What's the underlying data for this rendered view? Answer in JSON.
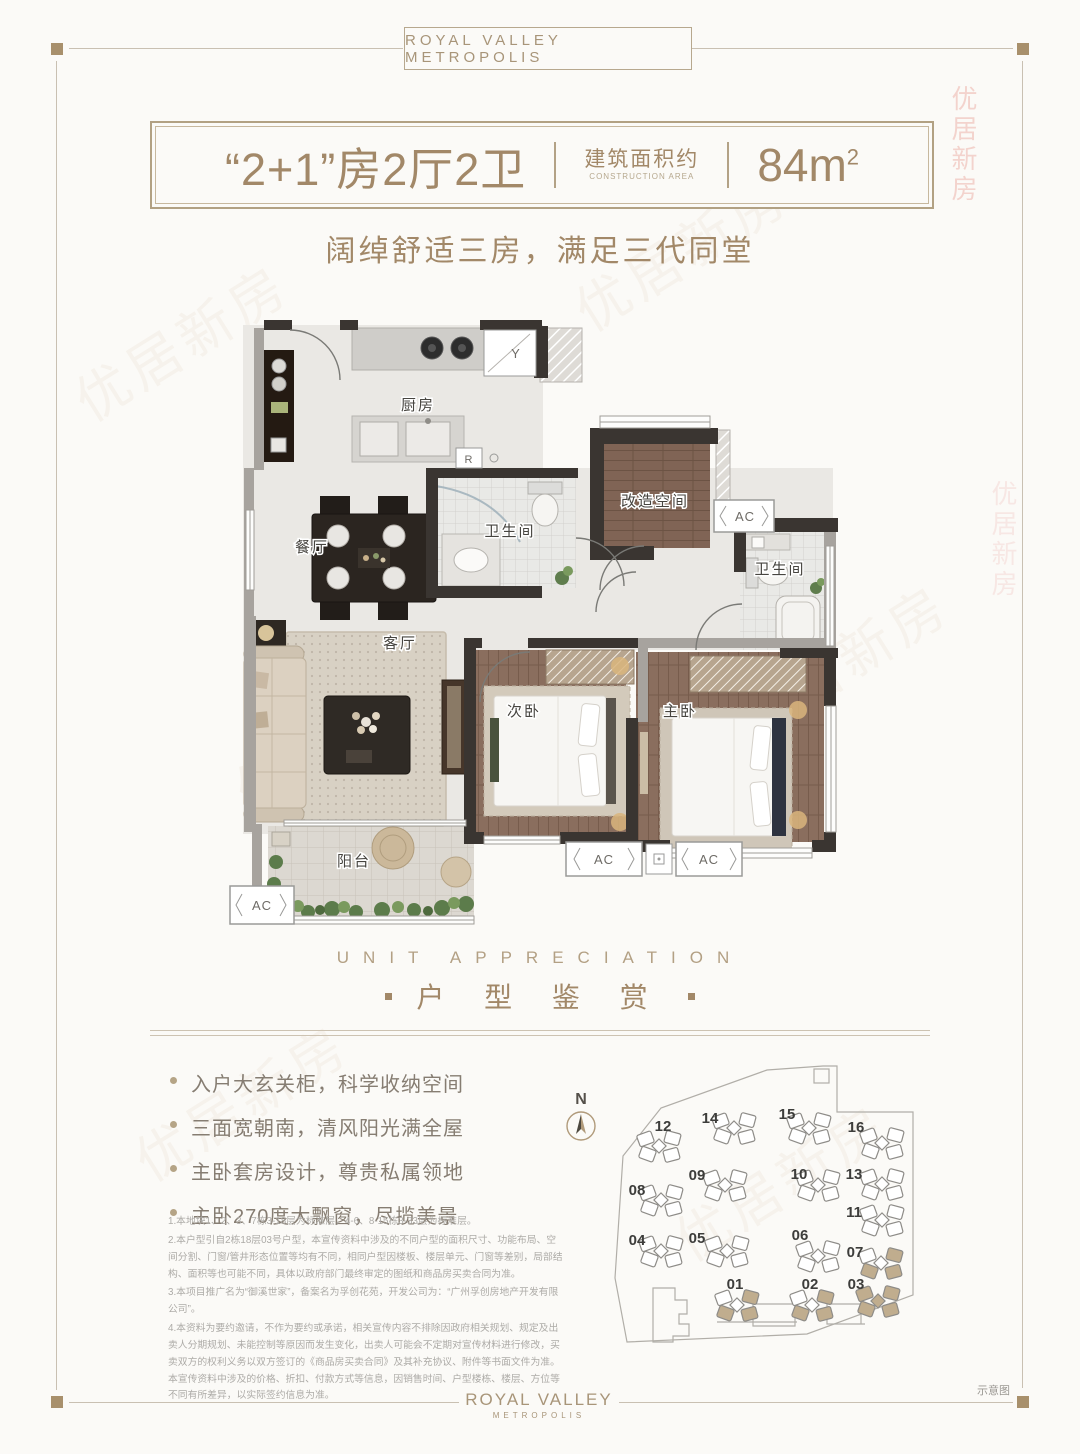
{
  "brand": {
    "header": "ROYAL VALLEY METROPOLIS",
    "footer_line1": "ROYAL VALLEY",
    "footer_line2": "METROPOLIS"
  },
  "title": {
    "layout": "“2+1”房2厅2卫",
    "area_label_cn": "建筑面积约",
    "area_label_en": "CONSTRUCTION AREA",
    "area_value": "84m",
    "area_sup": "2"
  },
  "subtitle": "阔绰舒适三房，满足三代同堂",
  "section": {
    "en": "UNIT APPRECIATION",
    "cn": "户 型 鉴 赏"
  },
  "floorplan": {
    "rooms": {
      "kitchen": "厨房",
      "dining": "餐厅",
      "living": "客厅",
      "bath1": "卫生间",
      "bath2": "卫生间",
      "flex": "改造空间",
      "bedroom2": "次卧",
      "master": "主卧",
      "balcony": "阳台"
    },
    "markers": {
      "ac": "AC",
      "y": "Y",
      "r": "R"
    }
  },
  "features": [
    "入户大玄关柜，科学收纳空间",
    "三面宽朝南，清风阳光满全屋",
    "主卧套房设计，尊贵私属领地",
    "主卧270度大飘窗，尽揽美景"
  ],
  "disclaimer": [
    "1.本地块1、2、3、7栋3-18层为标准层，4-6、8-15栋3-33层为标准层。",
    "2.本户型引自2栋18层03号户型，本宣传资料中涉及的不同户型的面积尺寸、功能布局、空间分割、门窗/管井形态位置等均有不同，相同户型因楼板、楼层单元、门窗等差别，局部结构、面积等也可能不同，具体以政府部门最终审定的图纸和商品房买卖合同为准。",
    "3.本项目推广名为“御溪世家”，备案名为孚创花苑，开发公司为：“广州孚创房地产开发有限公司”。",
    "4.本资料为要约邀请，不作为要约或承诺，相关宣传内容不排除因政府相关规划、规定及出卖人分期规划、未能控制等原因而发生变化，出卖人可能会不定期对宣传材料进行修改，买卖双方的权利义务以双方签订的《商品房买卖合同》及其补充协议、附件等书面文件为准。本宣传资料中涉及的价格、折扣、付款方式等信息，因销售时间、户型楼栋、楼层、方位等不同有所差异，以实际签约信息为准。"
  ],
  "siteplan": {
    "north": "N",
    "note": "示意图",
    "buildings": [
      {
        "num": "12",
        "cx": 94,
        "cy": 94,
        "lx": 98,
        "ly": 74,
        "state": "normal"
      },
      {
        "num": "14",
        "cx": 169,
        "cy": 76,
        "lx": 145,
        "ly": 66,
        "state": "normal"
      },
      {
        "num": "15",
        "cx": 244,
        "cy": 76,
        "lx": 222,
        "ly": 62,
        "state": "normal"
      },
      {
        "num": "16",
        "cx": 317,
        "cy": 91,
        "lx": 291,
        "ly": 75,
        "state": "normal"
      },
      {
        "num": "08",
        "cx": 96,
        "cy": 148,
        "lx": 72,
        "ly": 138,
        "state": "normal"
      },
      {
        "num": "09",
        "cx": 160,
        "cy": 133,
        "lx": 132,
        "ly": 123,
        "state": "normal"
      },
      {
        "num": "10",
        "cx": 253,
        "cy": 133,
        "lx": 234,
        "ly": 122,
        "state": "normal"
      },
      {
        "num": "13",
        "cx": 317,
        "cy": 132,
        "lx": 289,
        "ly": 122,
        "state": "normal"
      },
      {
        "num": "04",
        "cx": 96,
        "cy": 199,
        "lx": 72,
        "ly": 188,
        "state": "normal"
      },
      {
        "num": "05",
        "cx": 162,
        "cy": 199,
        "lx": 132,
        "ly": 186,
        "state": "normal"
      },
      {
        "num": "06",
        "cx": 253,
        "cy": 204,
        "lx": 235,
        "ly": 183,
        "state": "normal"
      },
      {
        "num": "11",
        "cx": 317,
        "cy": 168,
        "lx": 289,
        "ly": 160,
        "state": "normal"
      },
      {
        "num": "07",
        "cx": 316,
        "cy": 211,
        "lx": 290,
        "ly": 200,
        "state": "partial"
      },
      {
        "num": "01",
        "cx": 172,
        "cy": 253,
        "lx": 170,
        "ly": 232,
        "state": "partial"
      },
      {
        "num": "02",
        "cx": 247,
        "cy": 253,
        "lx": 245,
        "ly": 232,
        "state": "partial"
      },
      {
        "num": "03",
        "cx": 313,
        "cy": 249,
        "lx": 291,
        "ly": 232,
        "state": "full"
      }
    ]
  },
  "watermark": "优居新房",
  "colors": {
    "accent": "#a28868",
    "wall": "#3a3531",
    "highlight": "#c0ad8e"
  }
}
